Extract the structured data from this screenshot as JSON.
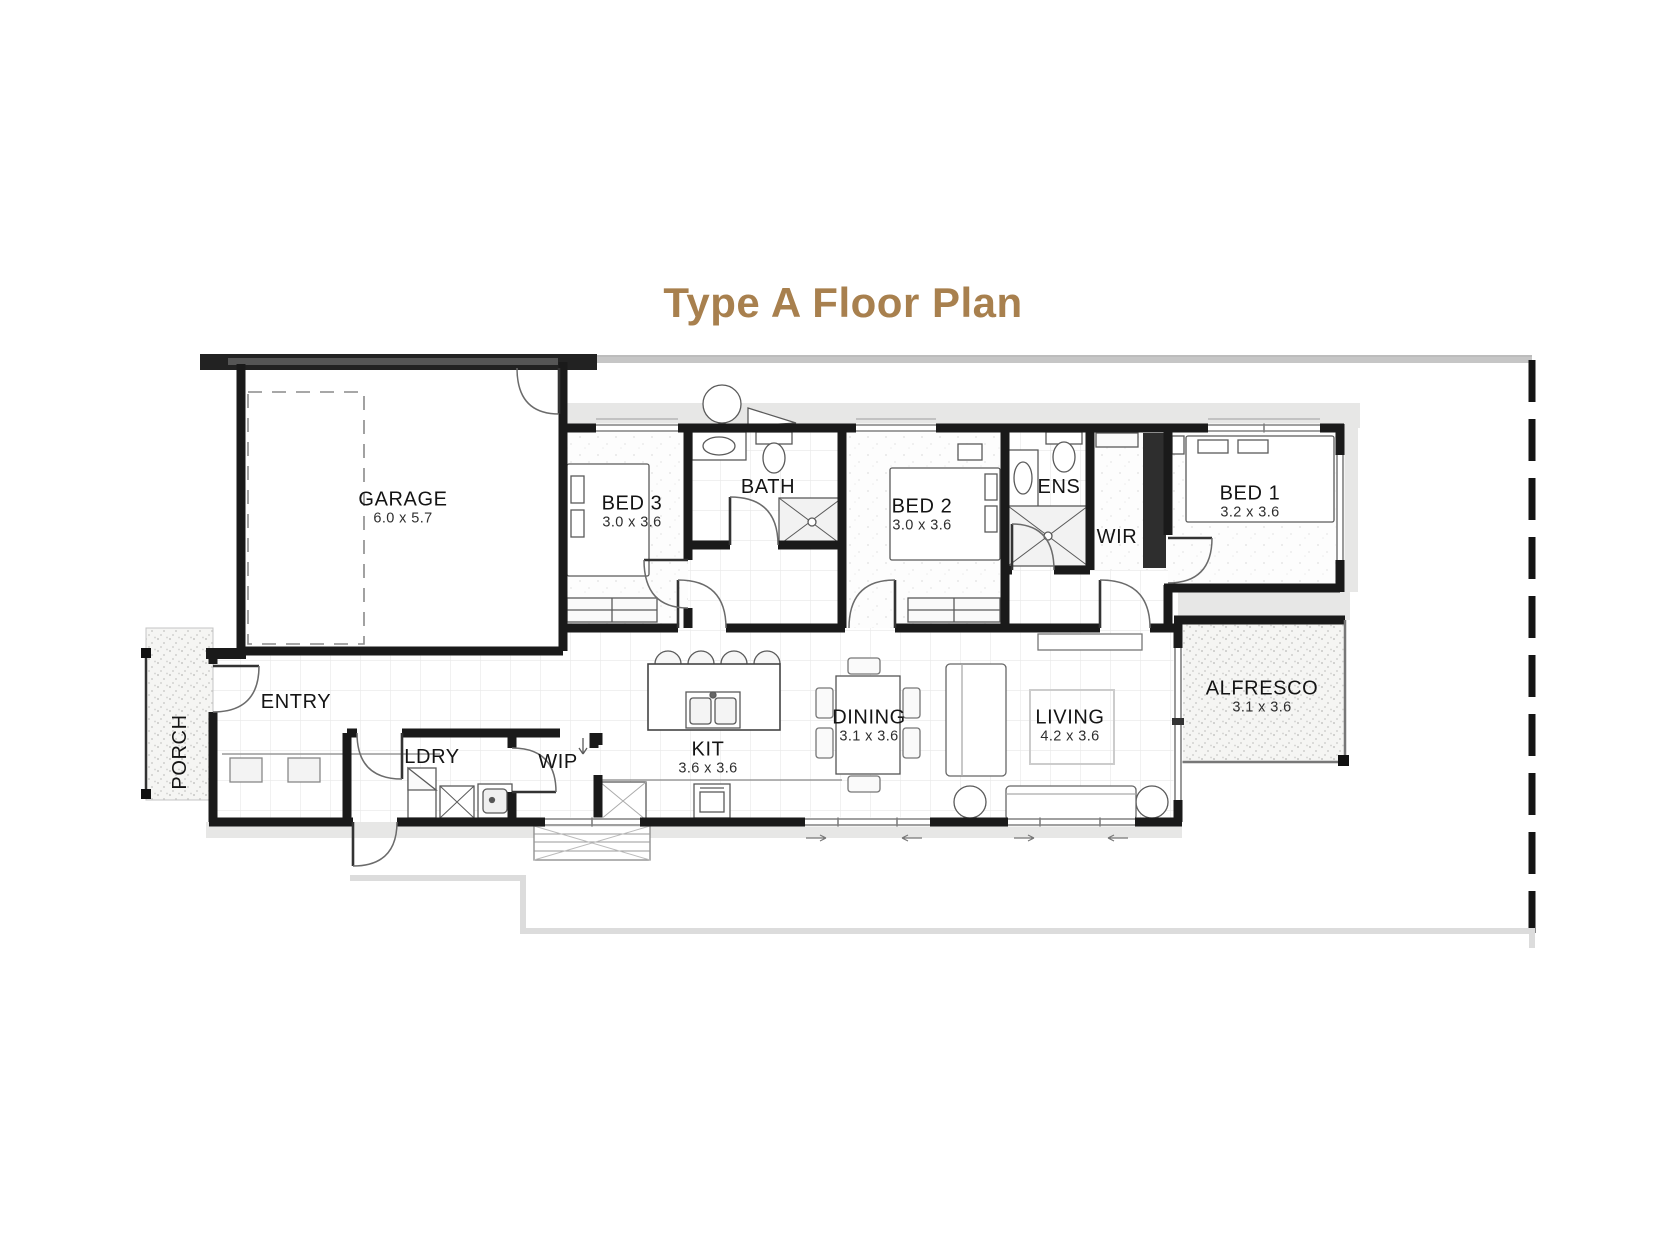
{
  "title": {
    "text": "Type A Floor Plan",
    "color": "#a8804e"
  },
  "plan": {
    "rooms": {
      "garage": {
        "label": "GARAGE",
        "dims": "6.0 x 5.7"
      },
      "bed3": {
        "label": "BED 3",
        "dims": "3.0 x 3.6"
      },
      "bath": {
        "label": "BATH"
      },
      "bed2": {
        "label": "BED 2",
        "dims": "3.0 x 3.6"
      },
      "ens": {
        "label": "ENS"
      },
      "wir": {
        "label": "WIR"
      },
      "bed1": {
        "label": "BED 1",
        "dims": "3.2 x 3.6"
      },
      "entry": {
        "label": "ENTRY"
      },
      "porch": {
        "label": "PORCH"
      },
      "ldry": {
        "label": "LDRY"
      },
      "wip": {
        "label": "WIP"
      },
      "kit": {
        "label": "KIT",
        "dims": "3.6 x 3.6"
      },
      "dining": {
        "label": "DINING",
        "dims": "3.1 x 3.6"
      },
      "living": {
        "label": "LIVING",
        "dims": "4.2 x 3.6"
      },
      "alfresco": {
        "label": "ALFRESCO",
        "dims": "3.1 x 3.6"
      }
    },
    "colors": {
      "wall": "#1a1a1a",
      "title_accent": "#a8804e",
      "eave": "#e7e7e6",
      "site_line": "#d8d8d8"
    }
  }
}
